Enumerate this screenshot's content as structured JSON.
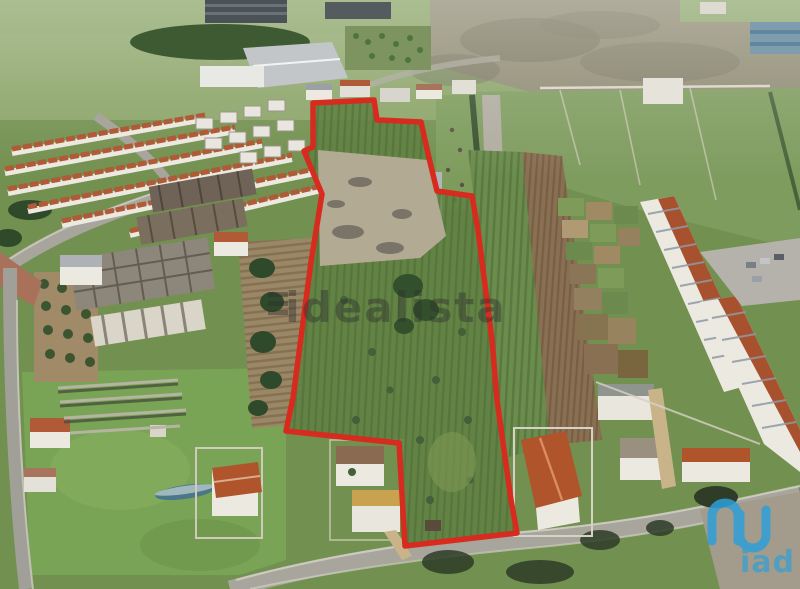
{
  "photo": {
    "kind": "aerial-drone-photo-of-land-plot",
    "width_px": 800,
    "height_px": 589
  },
  "watermark": {
    "text": "idealista",
    "color": "#2f2f2f",
    "opacity": 0.42
  },
  "brand": {
    "text": "iad",
    "color": "#2e9fd6"
  },
  "boundary": {
    "color": "#d62b1e",
    "stroke_width": 5.5,
    "points": "313,103 374,100 377,120 421,122 429,158 437,191 472,196 478,230 492,340 497,400 511,500 517,533 405,546 399,443 286,431 293,398 311,262 322,194 304,151 313,147"
  },
  "palette": {
    "grass_base": "#72904f",
    "meadow": "#7aa455",
    "plot_interior": "#5f8142",
    "scrubland": "#8e8a72",
    "plowed_field": "#8a7052",
    "road": "#a7a59c",
    "terracotta_roof": "#b05a38",
    "white_walls": "#ece9e1",
    "warehouse_roof": "#c2c6c8",
    "blue_building": "#7f9dae",
    "tree_dark": "#3b5531"
  }
}
